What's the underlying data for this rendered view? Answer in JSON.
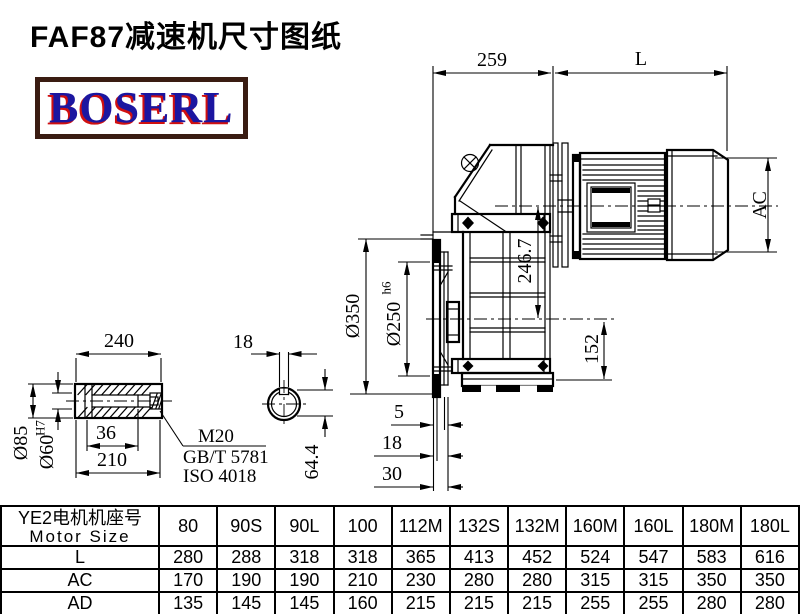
{
  "title": "FAF87减速机尺寸图纸",
  "logo": {
    "text": "BOSERL"
  },
  "colors": {
    "line": "#000000",
    "logo_text": "#1c16a0",
    "logo_shadow": "#d01010",
    "logo_border": "#3a1c12"
  },
  "main_view": {
    "d259": "259",
    "dL": "L",
    "dAC": "AC",
    "d2467": "246.7",
    "d152": "152",
    "d350": "Ø350",
    "d250": "Ø250",
    "d250t": "h6",
    "d5": "5",
    "d18": "18",
    "d30": "30"
  },
  "shaft_view": {
    "d240": "240",
    "d85": "Ø85",
    "d60": "Ø60",
    "d60t": "H7",
    "d36": "36",
    "d210": "210",
    "m20": "M20",
    "gb": "GB/T 5781",
    "iso": "ISO 4018"
  },
  "section_view": {
    "d18": "18",
    "d644": "64.4"
  },
  "table": {
    "header_cn": "YE2电机机座号",
    "header_en": "Motor Size",
    "columns": [
      "80",
      "90S",
      "90L",
      "100",
      "112M",
      "132S",
      "132M",
      "160M",
      "160L",
      "180M",
      "180L"
    ],
    "rows": [
      {
        "label": "L",
        "values": [
          "280",
          "288",
          "318",
          "318",
          "365",
          "413",
          "452",
          "524",
          "547",
          "583",
          "616"
        ]
      },
      {
        "label": "AC",
        "values": [
          "170",
          "190",
          "190",
          "210",
          "230",
          "280",
          "280",
          "315",
          "315",
          "350",
          "350"
        ]
      },
      {
        "label": "AD",
        "values": [
          "135",
          "145",
          "145",
          "160",
          "215",
          "215",
          "215",
          "255",
          "255",
          "280",
          "280"
        ]
      }
    ]
  }
}
